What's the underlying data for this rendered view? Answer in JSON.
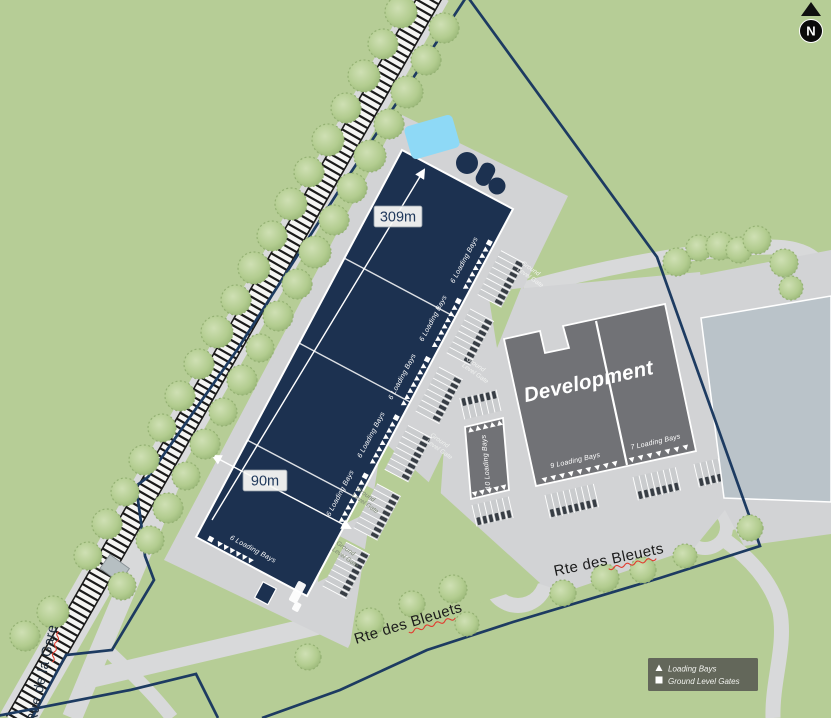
{
  "map": {
    "north_label": "N",
    "dimensions": {
      "length": "309m",
      "width": "90m"
    },
    "development_label": "Development",
    "roads": {
      "bleuets": "Rte des Bleuets",
      "gare": "Rue de la Gare"
    },
    "loading_bays": {
      "main": "6 Loading Bays",
      "small_block": "10 Loading Bays",
      "left_block": "9 Loading Bays",
      "right_block": "7 Loading Bays"
    },
    "ground_level_gate": {
      "line1": "Ground",
      "line2": "Level Gate"
    },
    "legend": {
      "items": [
        {
          "symbol": "triangle",
          "label": "Loading Bays"
        },
        {
          "symbol": "square",
          "label": "Ground Level Gates"
        }
      ]
    },
    "colors": {
      "grass": "#b6cd96",
      "road": "#d8d9da",
      "apron": "#d2d3d5",
      "main_building": "#1c3150",
      "development_building": "#717276",
      "neighbor_building": "#bac3c9",
      "water": "#8ed9f6",
      "boundary": "#1d3b61",
      "legend_bg": "#5d6156",
      "spellcheck_underline": "#e23b30"
    }
  }
}
